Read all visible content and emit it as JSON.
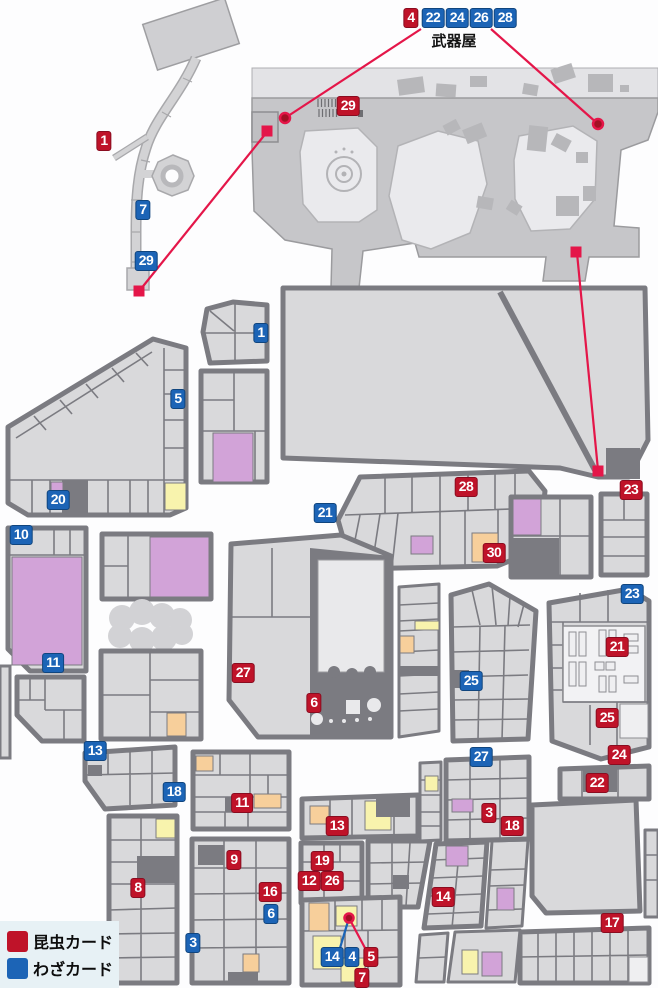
{
  "legend": {
    "items": [
      {
        "type": "insect",
        "label": "昆虫カード",
        "color": "#bf1329"
      },
      {
        "type": "waza",
        "label": "わざカード",
        "color": "#1c64b6"
      }
    ]
  },
  "labels": {
    "weapon_shop": "武器屋"
  },
  "map": {
    "markers": [
      {
        "label": "1",
        "type": "insect",
        "x": 104,
        "y": 141
      },
      {
        "label": "7",
        "type": "waza",
        "x": 143,
        "y": 210
      },
      {
        "label": "29",
        "type": "waza",
        "x": 146,
        "y": 261
      },
      {
        "label": "4",
        "type": "insect",
        "x": 411,
        "y": 18
      },
      {
        "label": "22",
        "type": "waza",
        "x": 433,
        "y": 18
      },
      {
        "label": "24",
        "type": "waza",
        "x": 457,
        "y": 18
      },
      {
        "label": "26",
        "type": "waza",
        "x": 481,
        "y": 18
      },
      {
        "label": "28",
        "type": "waza",
        "x": 505,
        "y": 18
      },
      {
        "label": "29",
        "type": "insect",
        "x": 348,
        "y": 106
      },
      {
        "label": "1",
        "type": "waza",
        "x": 261,
        "y": 333
      },
      {
        "label": "5",
        "type": "waza",
        "x": 178,
        "y": 399
      },
      {
        "label": "20",
        "type": "waza",
        "x": 58,
        "y": 500
      },
      {
        "label": "10",
        "type": "waza",
        "x": 21,
        "y": 535
      },
      {
        "label": "21",
        "type": "waza",
        "x": 325,
        "y": 513
      },
      {
        "label": "28",
        "type": "insect",
        "x": 466,
        "y": 487
      },
      {
        "label": "23",
        "type": "insect",
        "x": 631,
        "y": 490
      },
      {
        "label": "30",
        "type": "insect",
        "x": 494,
        "y": 553
      },
      {
        "label": "23",
        "type": "waza",
        "x": 632,
        "y": 594
      },
      {
        "label": "11",
        "type": "waza",
        "x": 53,
        "y": 663
      },
      {
        "label": "27",
        "type": "insect",
        "x": 243,
        "y": 673
      },
      {
        "label": "21",
        "type": "insect",
        "x": 617,
        "y": 647
      },
      {
        "label": "25",
        "type": "waza",
        "x": 471,
        "y": 681
      },
      {
        "label": "6",
        "type": "insect",
        "x": 314,
        "y": 703
      },
      {
        "label": "25",
        "type": "insect",
        "x": 607,
        "y": 718
      },
      {
        "label": "13",
        "type": "waza",
        "x": 95,
        "y": 751
      },
      {
        "label": "24",
        "type": "insect",
        "x": 619,
        "y": 755
      },
      {
        "label": "27",
        "type": "waza",
        "x": 481,
        "y": 757
      },
      {
        "label": "22",
        "type": "insect",
        "x": 597,
        "y": 783
      },
      {
        "label": "18",
        "type": "waza",
        "x": 174,
        "y": 792
      },
      {
        "label": "11",
        "type": "insect",
        "x": 242,
        "y": 803
      },
      {
        "label": "3",
        "type": "insect",
        "x": 489,
        "y": 813
      },
      {
        "label": "13",
        "type": "insect",
        "x": 337,
        "y": 826
      },
      {
        "label": "18",
        "type": "insect",
        "x": 512,
        "y": 826
      },
      {
        "label": "9",
        "type": "insect",
        "x": 234,
        "y": 860
      },
      {
        "label": "19",
        "type": "insect",
        "x": 322,
        "y": 861
      },
      {
        "label": "12",
        "type": "insect",
        "x": 309,
        "y": 881
      },
      {
        "label": "26",
        "type": "insect",
        "x": 332,
        "y": 881
      },
      {
        "label": "8",
        "type": "insect",
        "x": 138,
        "y": 888
      },
      {
        "label": "16",
        "type": "insect",
        "x": 270,
        "y": 892
      },
      {
        "label": "14",
        "type": "insect",
        "x": 443,
        "y": 897
      },
      {
        "label": "6",
        "type": "waza",
        "x": 271,
        "y": 914
      },
      {
        "label": "17",
        "type": "insect",
        "x": 612,
        "y": 923
      },
      {
        "label": "3",
        "type": "waza",
        "x": 193,
        "y": 943
      },
      {
        "label": "5",
        "type": "insect",
        "x": 371,
        "y": 957
      },
      {
        "label": "14",
        "type": "waza",
        "x": 332,
        "y": 957
      },
      {
        "label": "4",
        "type": "waza",
        "x": 352,
        "y": 957
      },
      {
        "label": "7",
        "type": "insect",
        "x": 362,
        "y": 978
      }
    ],
    "connector_lines": [
      {
        "x1": 421,
        "y1": 29,
        "x2": 285,
        "y2": 118,
        "color": "#e41649"
      },
      {
        "x1": 491,
        "y1": 29,
        "x2": 598,
        "y2": 124,
        "color": "#e41649"
      },
      {
        "x1": 267,
        "y1": 132,
        "x2": 140,
        "y2": 290,
        "color": "#e41649"
      },
      {
        "x1": 577,
        "y1": 253,
        "x2": 598,
        "y2": 470,
        "color": "#e41649"
      },
      {
        "x1": 349,
        "y1": 918,
        "x2": 340,
        "y2": 948,
        "color": "#1c64b6"
      },
      {
        "x1": 349,
        "y1": 918,
        "x2": 365,
        "y2": 948,
        "color": "#e41649"
      }
    ],
    "dots": [
      {
        "x": 285,
        "y": 118,
        "r": 5
      },
      {
        "x": 598,
        "y": 124,
        "r": 5
      },
      {
        "x": 349,
        "y": 918,
        "r": 4.5
      }
    ],
    "squares": [
      {
        "x": 267,
        "y": 131
      },
      {
        "x": 139,
        "y": 291
      },
      {
        "x": 576,
        "y": 252
      },
      {
        "x": 598,
        "y": 471
      }
    ],
    "dot_fill": "#a31024",
    "dot_stroke": "#e41649",
    "square_color": "#e41649"
  }
}
